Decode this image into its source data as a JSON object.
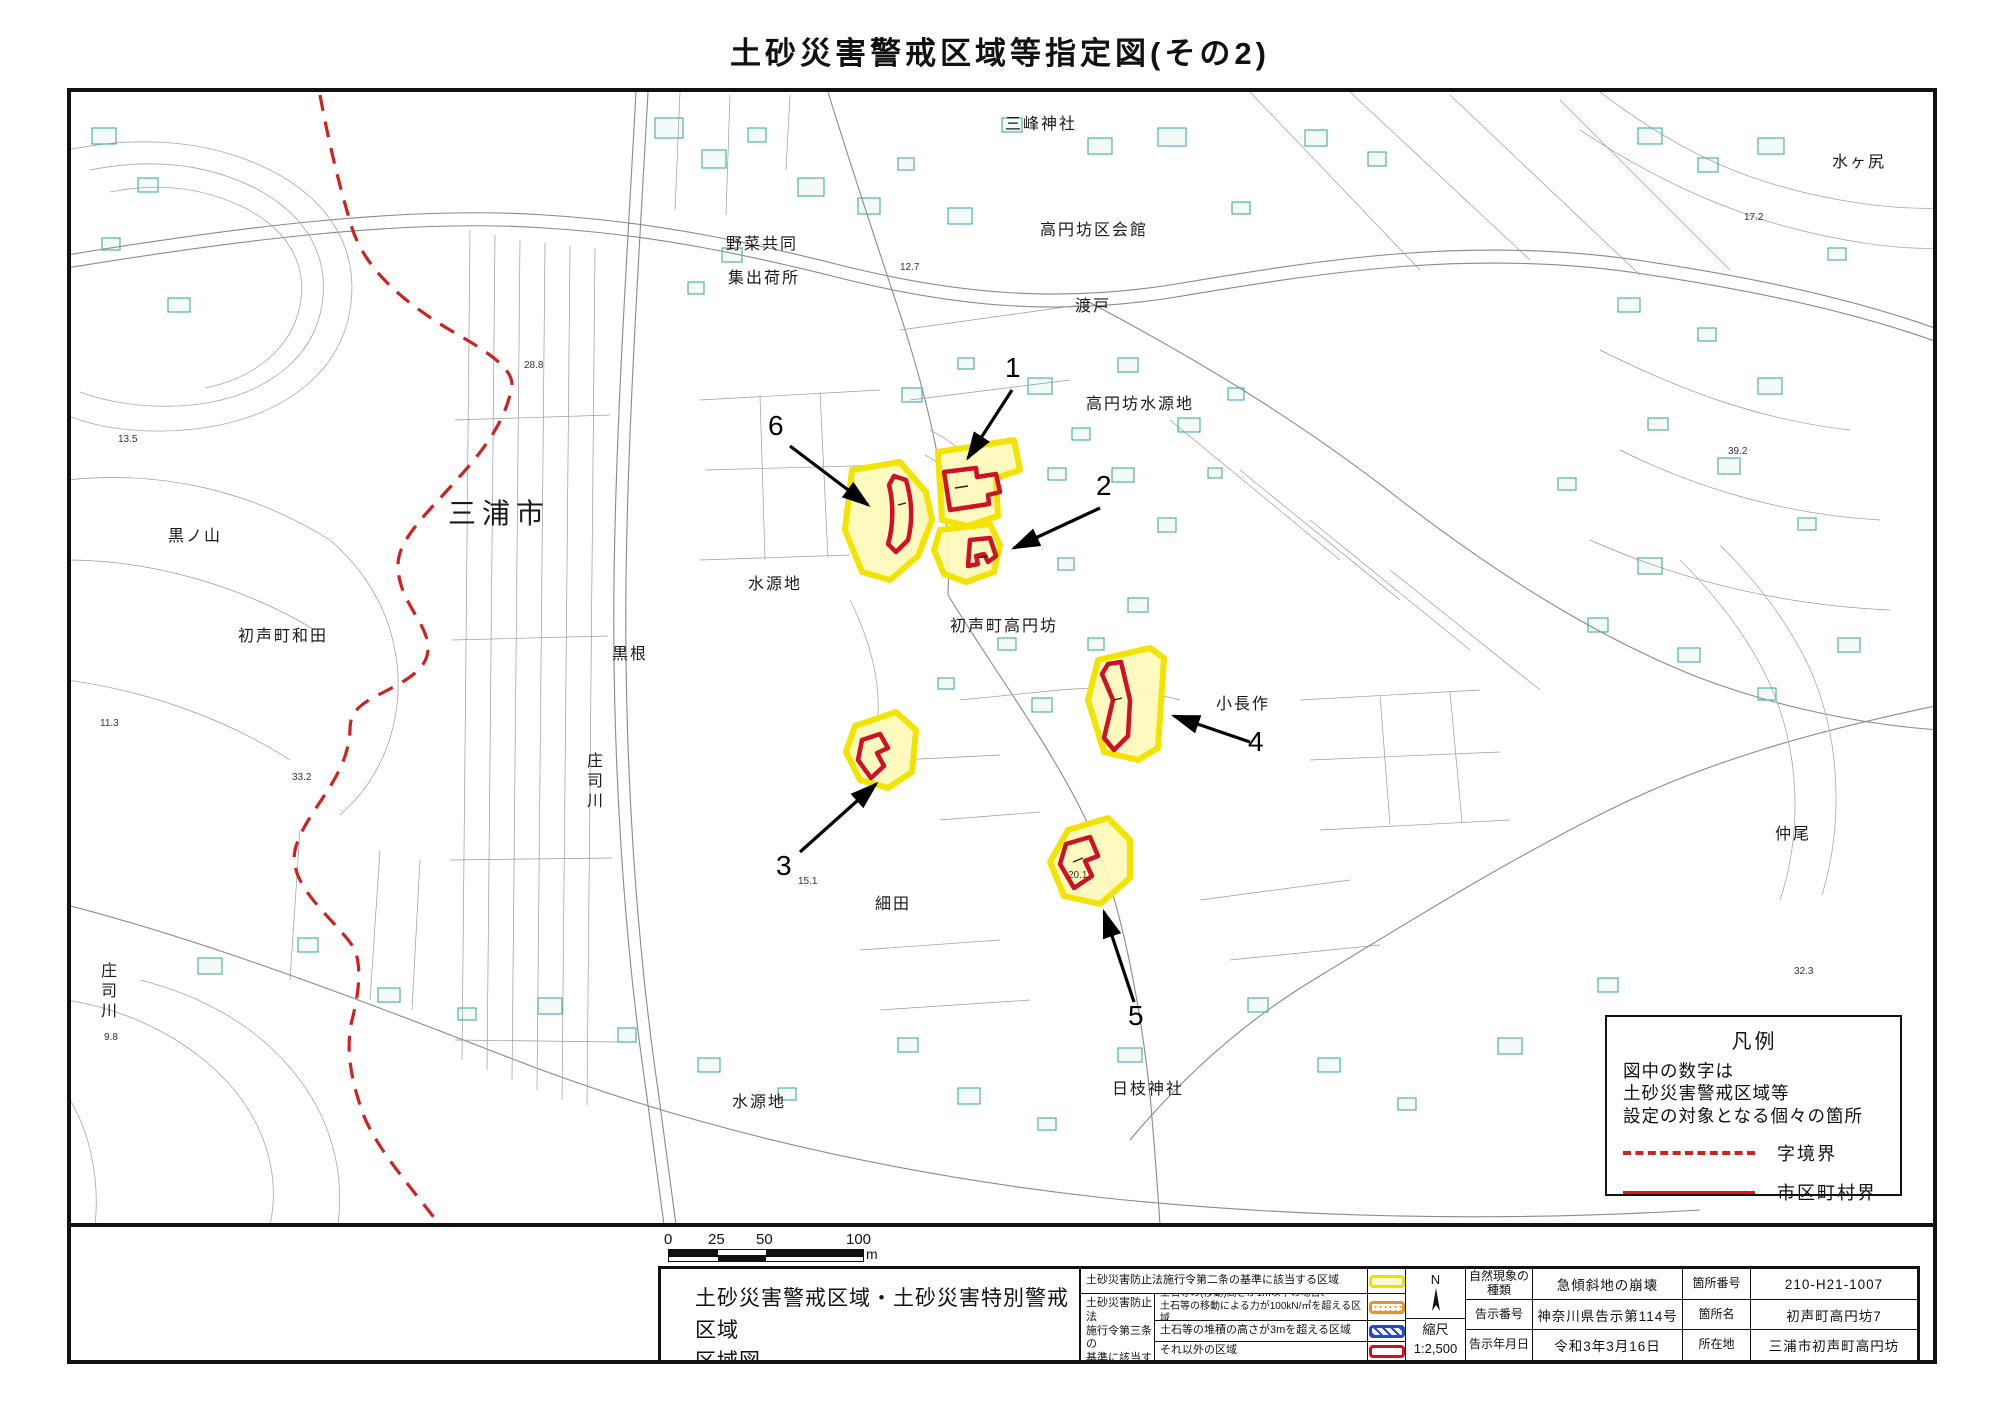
{
  "page": {
    "title": "土砂災害警戒区域等指定図(その2)"
  },
  "colors": {
    "zone_yellow_border": "#f2e400",
    "zone_yellow_fill": "#fdf8b8",
    "zone_red": "#cf1125",
    "boundary_red_dashed": "#cc2222",
    "building_teal": "#4fb3a2",
    "legend_orange": "#e8941e",
    "legend_blue": "#2149c8"
  },
  "map": {
    "place_labels": {
      "mitsumine_jinja": "三峰神社",
      "kouenbou_kukaikan": "高円坊区会館",
      "yasai_kyodo": "野菜共同",
      "shukkajo": "集出荷所",
      "watado": "渡戸",
      "mizugajiri": "水ヶ尻",
      "kouenbou_suigenchi": "高円坊水源地",
      "miura_shi": "三浦市",
      "kuronoyama": "黒ノ山",
      "hassemachi_wada": "初声町和田",
      "suigenchi_mid": "水源地",
      "kurone": "黒根",
      "shojigawa_mid": "庄司川",
      "hassemachi_kouenbou": "初声町高円坊",
      "konagasaku": "小長作",
      "hosoda": "細田",
      "nakao": "仲尾",
      "shojigawa_sw": "庄司川",
      "suigenchi_south": "水源地",
      "hie_jinja": "日枝神社"
    },
    "zone_markers": {
      "z1": "1",
      "z2": "2",
      "z3": "3",
      "z4": "4",
      "z5": "5",
      "z6": "6"
    },
    "spot_elevations": {
      "e1": "12.7",
      "e2": "28.8",
      "e3": "13.5",
      "e4": "11.3",
      "e5": "33.2",
      "e6": "9.8",
      "e7": "15.1",
      "e8": "20.1",
      "e9": "17.2",
      "e10": "39.2",
      "e11": "32.3"
    },
    "legend_box": {
      "title": "凡例",
      "note_line1": "図中の数字は",
      "note_line2": "土砂災害警戒区域等",
      "note_line3": "設定の対象となる個々の箇所",
      "dashed_label": "字境界",
      "solid_label": "市区町村界"
    }
  },
  "scale_bar": {
    "t0": "0",
    "t25": "25",
    "t50": "50",
    "t100": "100",
    "unit": "m"
  },
  "title_block": {
    "map_title_line1": "土砂災害警戒区域・土砂災害特別警戒区域",
    "map_title_line2": "区域図",
    "law2_label": "土砂災害防止法施行令第二条の基準に該当する区域",
    "law3_group_l1": "土砂災害防止法",
    "law3_group_l2": "施行令第三条の",
    "law3_group_l3": "基準に該当する",
    "law3_group_l4": "区域",
    "law3_row1_l1": "土石等の(移動)高さが1m以下の場合、",
    "law3_row1_l2": "土石等の移動による力が100kN/㎡を超える区域",
    "law3_row2": "土石等の堆積の高さが3mを超える区域",
    "law3_row3": "それ以外の区域",
    "compass_label": "N",
    "scale_label": "縮尺",
    "scale_value": "1:2,500",
    "meta_rows": [
      {
        "k1": "自然現象の種類",
        "v1": "急傾斜地の崩壊",
        "k2": "箇所番号",
        "v2": "210-H21-1007"
      },
      {
        "k1": "告示番号",
        "v1": "神奈川県告示第114号",
        "k2": "箇所名",
        "v2": "初声町高円坊7"
      },
      {
        "k1": "告示年月日",
        "v1": "令和3年3月16日",
        "k2": "所在地",
        "v2": "三浦市初声町高円坊"
      }
    ]
  }
}
